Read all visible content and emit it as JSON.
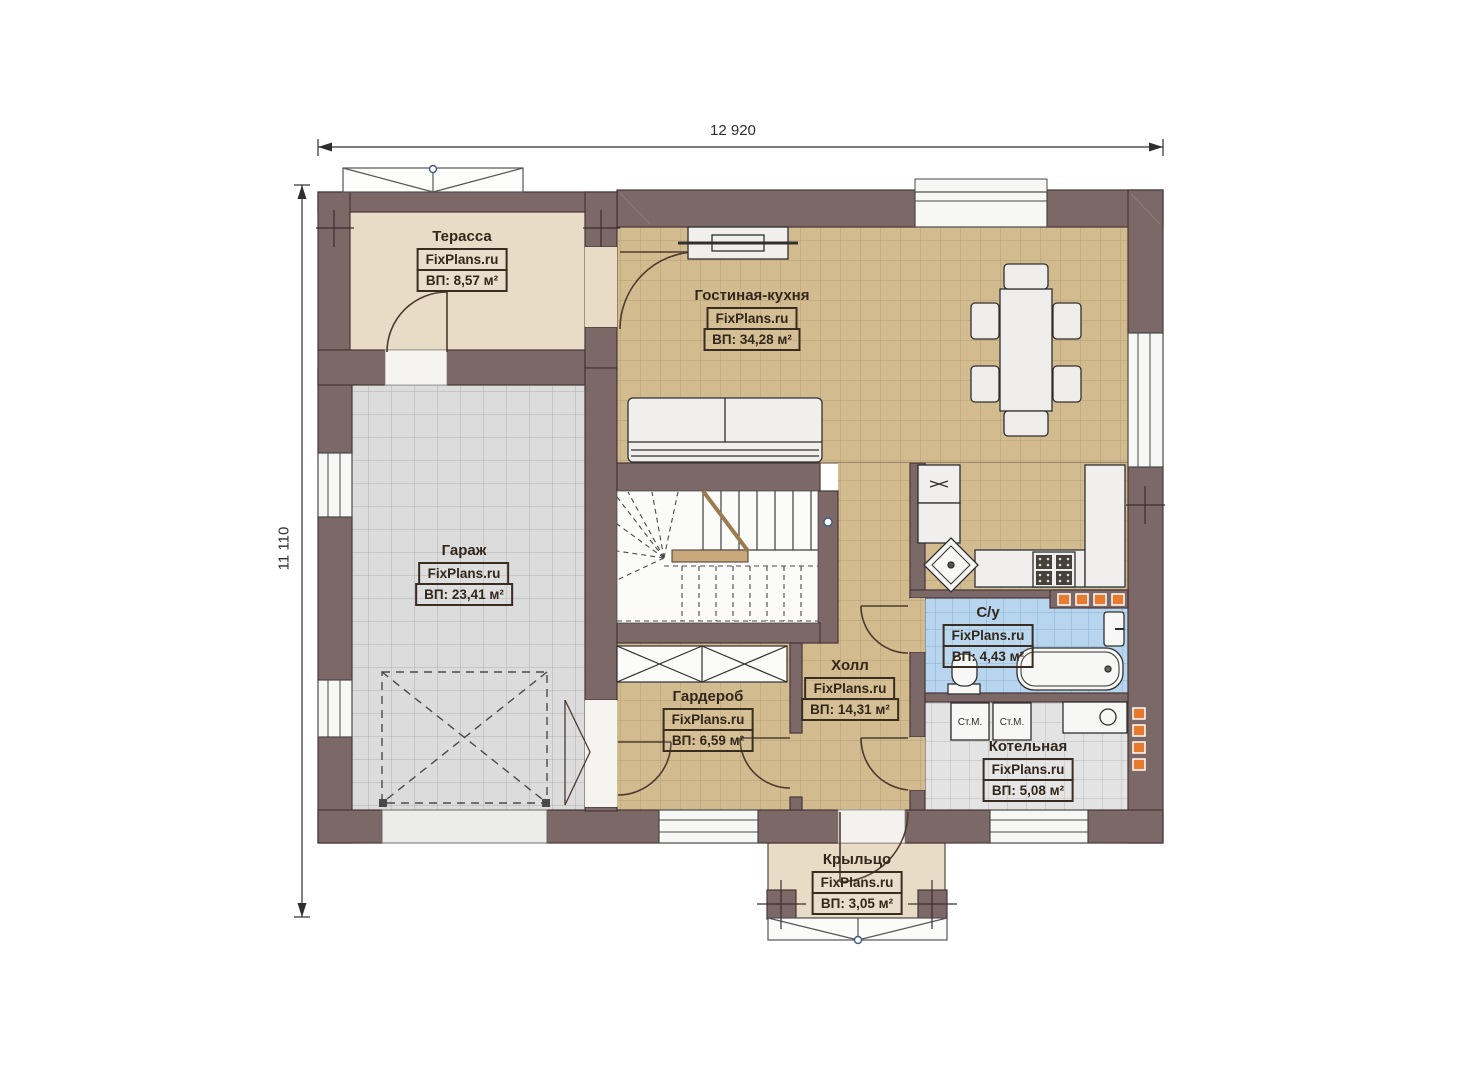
{
  "plan": {
    "title": "Floor plan — first floor",
    "source_watermark": "FixPlans.ru"
  },
  "dimensions": {
    "top_width": "12 920",
    "left_height": "11 110"
  },
  "rooms": [
    {
      "key": "terrace",
      "name": "Терасса",
      "watermark": "FixPlans.ru",
      "area": "ВП: 8,57 м²"
    },
    {
      "key": "living_kitchen",
      "name": "Гостиная-кухня",
      "watermark": "FixPlans.ru",
      "area": "ВП: 34,28 м²"
    },
    {
      "key": "garage",
      "name": "Гараж",
      "watermark": "FixPlans.ru",
      "area": "ВП: 23,41 м²"
    },
    {
      "key": "hall",
      "name": "Холл",
      "watermark": "FixPlans.ru",
      "area": "ВП: 14,31 м²"
    },
    {
      "key": "wardrobe",
      "name": "Гардероб",
      "watermark": "FixPlans.ru",
      "area": "ВП: 6,59 м²"
    },
    {
      "key": "bathroom",
      "name": "С/у",
      "watermark": "FixPlans.ru",
      "area": "ВП: 4,43 м²"
    },
    {
      "key": "boiler",
      "name": "Котельная",
      "watermark": "FixPlans.ru",
      "area": "ВП: 5,08 м²"
    },
    {
      "key": "porch",
      "name": "Крыльцо",
      "watermark": "FixPlans.ru",
      "area": "ВП: 3,05 м²"
    }
  ],
  "appliances": {
    "washer1": "Ст.М.",
    "washer2": "Ст.М."
  },
  "colors": {
    "wall": "#7d6868",
    "floor_tan": "#d2bb8e",
    "floor_gray": "#dcdcdc",
    "floor_blue": "#b7d5ee",
    "floor_boiler": "#e3e3e3",
    "floor_beige": "#e8dcc7",
    "radiator_orange": "#e87a2e"
  }
}
